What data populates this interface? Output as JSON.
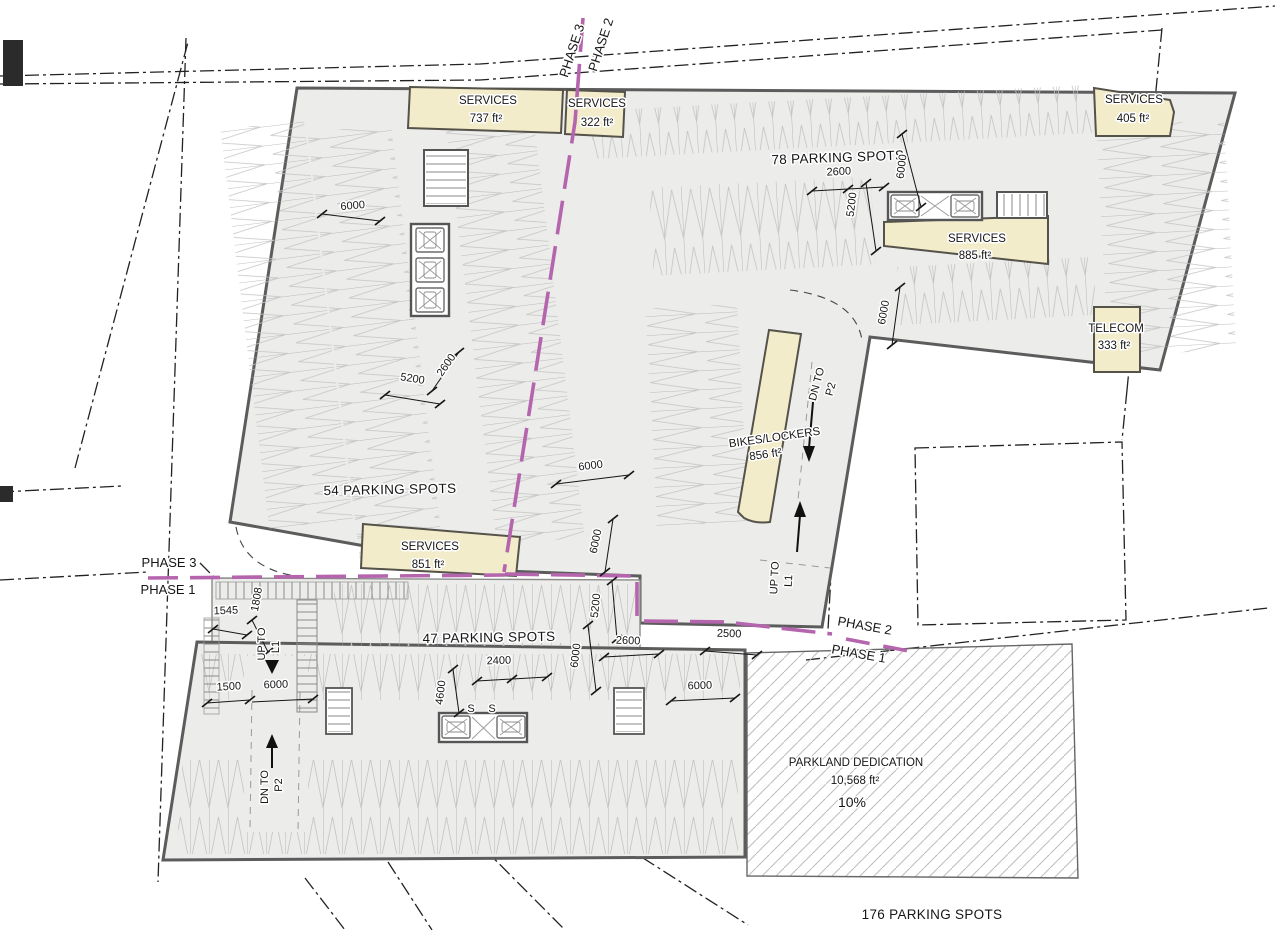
{
  "colors": {
    "floor": "#ececea",
    "room_fill": "#f2ecca",
    "wall": "#5c5c5c",
    "phase_line": "#b565ae",
    "ink": "#161616",
    "stall_line": "#a9a9a9"
  },
  "phase_labels": {
    "top_left": "PHASE 3",
    "top_right": "PHASE 2",
    "west_upper": "PHASE 3",
    "west_lower": "PHASE 1",
    "east_upper": "PHASE 2",
    "east_lower": "PHASE 1"
  },
  "rooms": {
    "services_737": {
      "name": "SERVICES",
      "area": "737 ft²"
    },
    "services_322": {
      "name": "SERVICES",
      "area": "322 ft²"
    },
    "services_405": {
      "name": "SERVICES",
      "area": "405 ft²"
    },
    "services_885": {
      "name": "SERVICES",
      "area": "885 ft²"
    },
    "telecom_333": {
      "name": "TELECOM",
      "area": "333 ft²"
    },
    "bikes_856": {
      "name": "BIKES/LOCKERS",
      "area": "856 ft²"
    },
    "services_851": {
      "name": "SERVICES",
      "area": "851 ft²"
    }
  },
  "parking": {
    "north_count": "78 PARKING SPOTS",
    "west_count": "54 PARKING SPOTS",
    "central_count": "47 PARKING SPOTS",
    "total_count": "176 PARKING SPOTS",
    "small_stall_1": "S",
    "small_stall_2": "S"
  },
  "circulation": {
    "dn_p2_north": {
      "line1": "DN TO",
      "line2": "P2"
    },
    "up_l1_east": {
      "line1": "UP TO",
      "line2": "L1"
    },
    "up_l1_west": {
      "line1": "UP TO",
      "line2": "L1"
    },
    "dn_p2_south": {
      "line1": "DN TO",
      "line2": "P2"
    }
  },
  "parkland": {
    "title": "PARKLAND DEDICATION",
    "area": "10,568 ft²",
    "percent": "10%"
  },
  "dimensions": {
    "aisle_nw": "6000",
    "stall_width_n": "2600",
    "aisle_n": "6000",
    "stall_depth_n": "5200",
    "aisle_ne": "6000",
    "stall_width_w": "2600",
    "stall_depth_w": "5200",
    "aisle_c": "6000",
    "aisle_c2": "6000",
    "stall_depth_c": "5200",
    "stall_width_c": "2600",
    "gap_e": "2500",
    "dim_1545": "1545",
    "dim_1808": "1808",
    "stall_width_s": "2400",
    "aisle_s1": "6000",
    "dim_1500": "1500",
    "aisle_sw": "6000",
    "dim_4600": "4600",
    "aisle_se": "6000"
  }
}
